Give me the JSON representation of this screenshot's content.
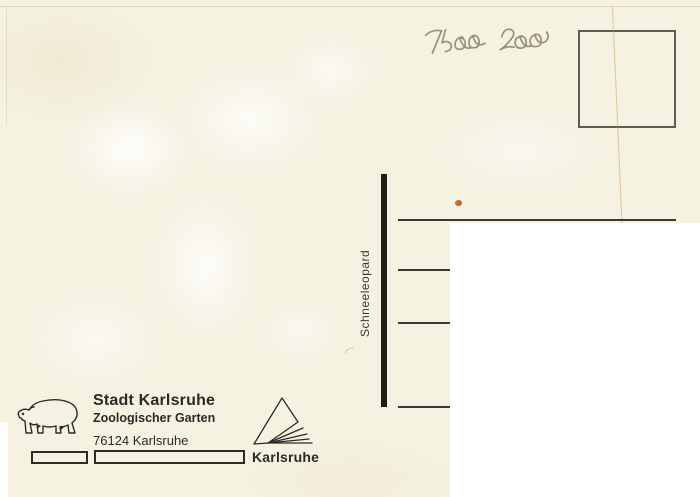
{
  "postcard": {
    "handwritten_note": "7500 Zoo",
    "divider_label": "Schneeleopard",
    "publisher": {
      "name": "Stadt Karlsruhe",
      "subtitle": "Zoologischer Garten",
      "postal": "76124 Karlsruhe"
    },
    "logo_label": "Karlsruhe"
  },
  "colors": {
    "card_background": "#f5f2e2",
    "ink": "#2d2924",
    "pencil": "#98907f",
    "divider_bar": "#241d17",
    "address_line": "#3a3831",
    "stamp_box_border": "#5f5a52",
    "stain": "#b85a24",
    "privacy_cover": "#ffffff"
  }
}
